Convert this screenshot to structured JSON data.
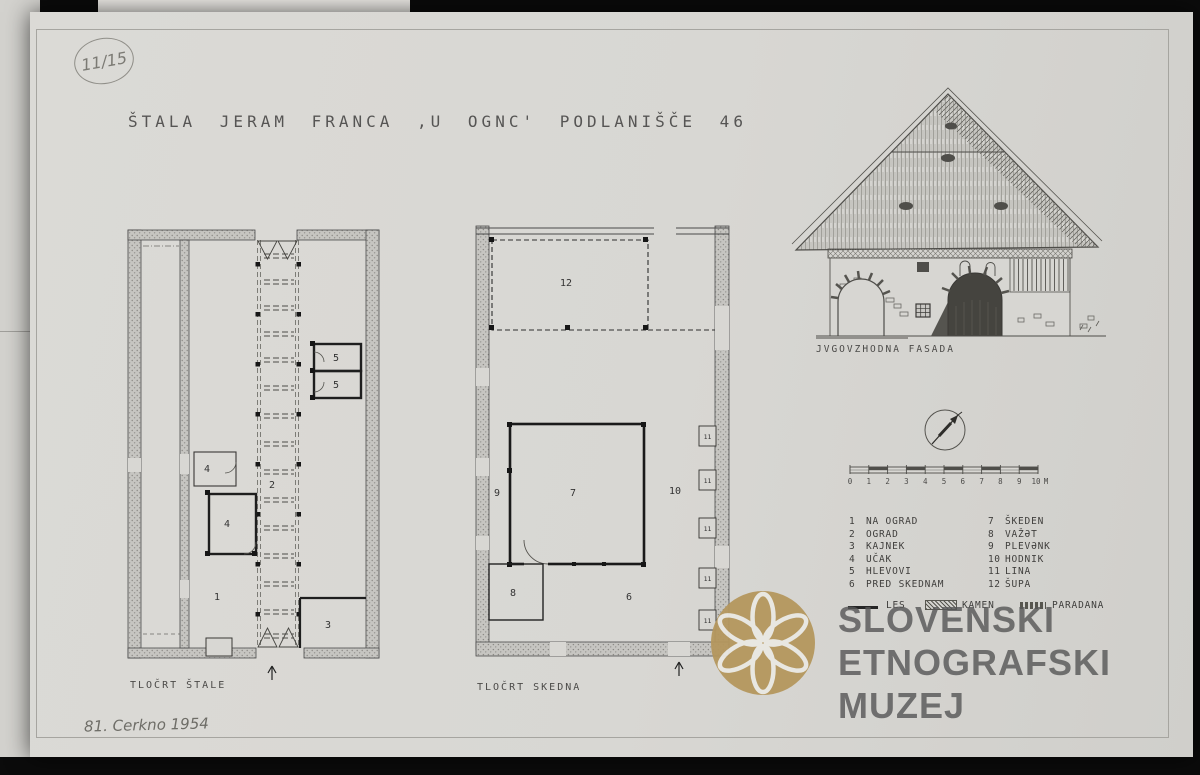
{
  "sheet": {
    "archive_number": "11/15",
    "title": "ŠTALA JERAM FRANCA ‚U OGNC' PODLANIŠČE 46",
    "signature": "81. Cerkno 1954"
  },
  "plans": {
    "stala": {
      "caption": "TLOČRT ŠTALE",
      "rooms": {
        "r1": "1",
        "r2": "2",
        "r3": "3",
        "r4a": "4",
        "r4b": "4",
        "r5a": "5",
        "r5b": "5"
      }
    },
    "skedna": {
      "caption": "TLOČRT SKEDNA",
      "rooms": {
        "r6": "6",
        "r7": "7",
        "r8": "8",
        "r9": "9",
        "r10": "10",
        "r11": "11",
        "r12": "12"
      }
    }
  },
  "facade": {
    "caption": "JVGOVZHODNA FASADA"
  },
  "scale_bar": {
    "ticks": [
      "0",
      "1",
      "2",
      "3",
      "4",
      "5",
      "6",
      "7",
      "8",
      "9",
      "10"
    ],
    "unit": "M"
  },
  "legend": {
    "items": [
      {
        "num": "1",
        "label": "NA OGRAD"
      },
      {
        "num": "2",
        "label": "OGRAD"
      },
      {
        "num": "3",
        "label": "KAJNEK"
      },
      {
        "num": "4",
        "label": "UČAK"
      },
      {
        "num": "5",
        "label": "HLEVOVI"
      },
      {
        "num": "6",
        "label": "PRED SKEDNAM"
      },
      {
        "num": "7",
        "label": "ŠKEDEN"
      },
      {
        "num": "8",
        "label": "VAŽƏT"
      },
      {
        "num": "9",
        "label": "PLEVƏNK"
      },
      {
        "num": "10",
        "label": "HODNIK"
      },
      {
        "num": "11",
        "label": "LINA"
      },
      {
        "num": "12",
        "label": "ŠUPA"
      }
    ],
    "materials": [
      {
        "label": "LES"
      },
      {
        "label": "KAMEN"
      },
      {
        "label": "PARADANA"
      }
    ]
  },
  "watermark": {
    "lines": [
      "SLOVENSKI",
      "ETNOGRAFSKI",
      "MUZEJ"
    ],
    "gold_color": "#b5975e",
    "text_color": "#585858"
  },
  "colors": {
    "paper": "#d8d7d3",
    "backdrop": "#0b0b0b",
    "ink": "#4a4a4a"
  }
}
